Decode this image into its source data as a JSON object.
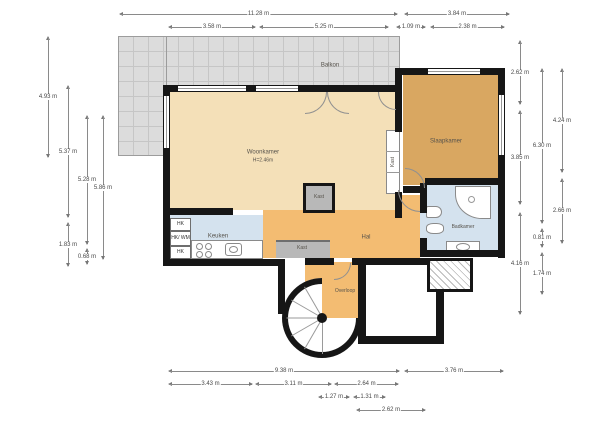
{
  "rooms": {
    "balkon": "Balkon",
    "woonkamer": "Woonkamer",
    "woonkamer_h": "H=2.46m",
    "slaapkamer": "Slaapkamer",
    "keuken": "Keuken",
    "hal": "Hal",
    "overloop": "Overloop",
    "badkamer": "Badkamer",
    "kast_a": "Kast",
    "kast_b": "Kast",
    "kast_c": "Kast",
    "hk1": "HK",
    "hk2": "HK/ WM",
    "hk3": "HK"
  },
  "dims": {
    "t1": "11.28 m",
    "t2": "3.84 m",
    "t3": "3.58 m",
    "t4": "5.25 m",
    "t5": "1.09 m",
    "t6": "2.38 m",
    "b1": "9.38 m",
    "b2": "3.76 m",
    "b3": "3.43 m",
    "b4": "3.11 m",
    "b5": "2.64 m",
    "b6": "1.27 m",
    "b7": "1.31 m",
    "b8": "2.62 m",
    "l1": "4.93 m",
    "l2": "5.37 m",
    "l3": "1.83 m",
    "l4": "5.28 m",
    "l5": "0.68 m",
    "l6": "5.86 m",
    "r1": "2.62 m",
    "r2": "3.85 m",
    "r3": "4.16 m",
    "r4": "6.30 m",
    "r5": "0.81 m",
    "r6": "1.74 m",
    "r7": "4.24 m",
    "r8": "2.66 m"
  },
  "colors": {
    "living": "#f4e0b8",
    "bedroom": "#d9a761",
    "hall": "#f3bc72",
    "wet": "#d4e2ee",
    "closet": "#b8b8b8",
    "balcony": "#dcdcdc",
    "wall": "#161616"
  }
}
